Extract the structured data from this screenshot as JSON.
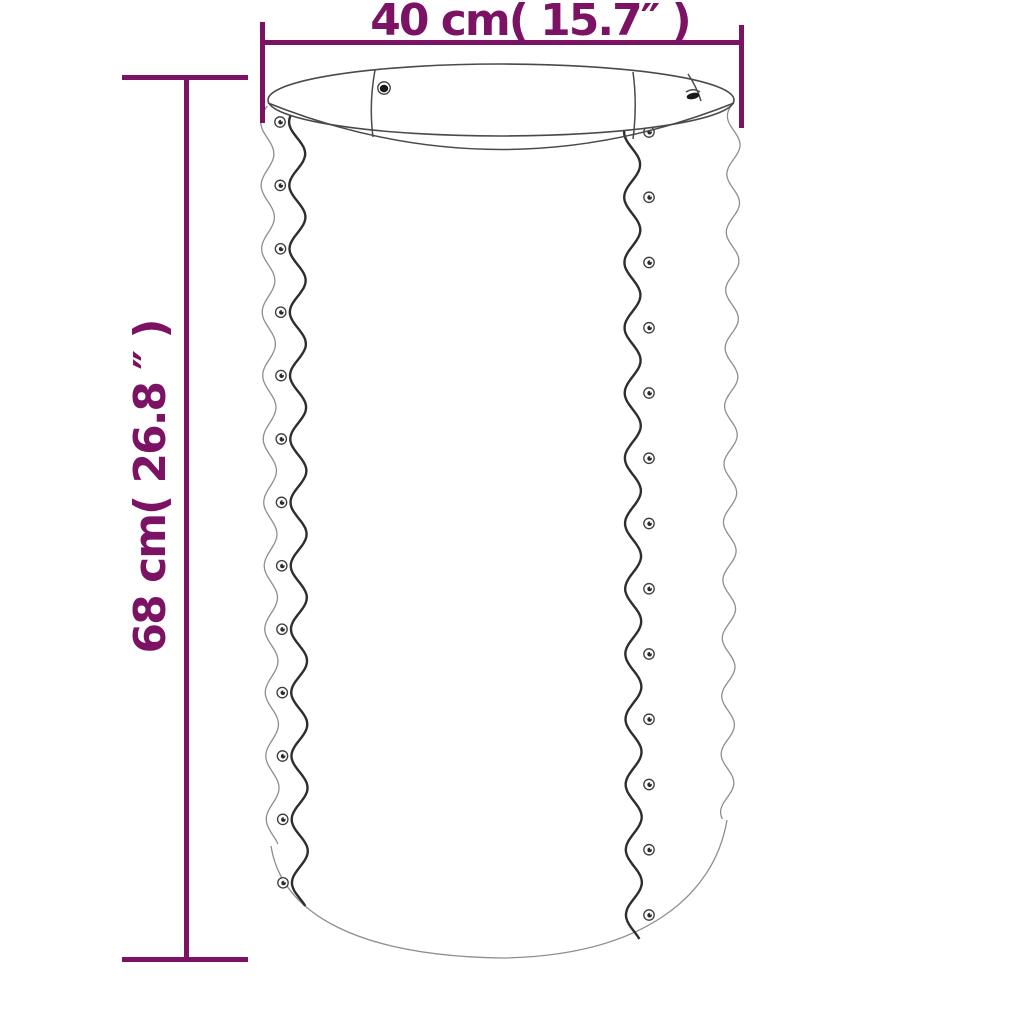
{
  "diagram": {
    "kind": "product-dimension-diagram",
    "illustration": {
      "name": "corrugated-round-planter",
      "left_rivet_count": 13,
      "right_rivet_count": 13,
      "rim_screw_count": 2
    },
    "dimensions": {
      "width": {
        "label": "40 cm( 15.7″ )",
        "value_cm": 40,
        "value_inch": 15.7
      },
      "height": {
        "label": "68 cm( 26.8 ″ )",
        "value_cm": 68,
        "value_inch": 26.8
      }
    },
    "colors": {
      "dimension_accent": "#7c1264",
      "line_art_dark": "#2e2e2e",
      "line_art_light": "#8e8e8e",
      "background": "#ffffff"
    }
  }
}
